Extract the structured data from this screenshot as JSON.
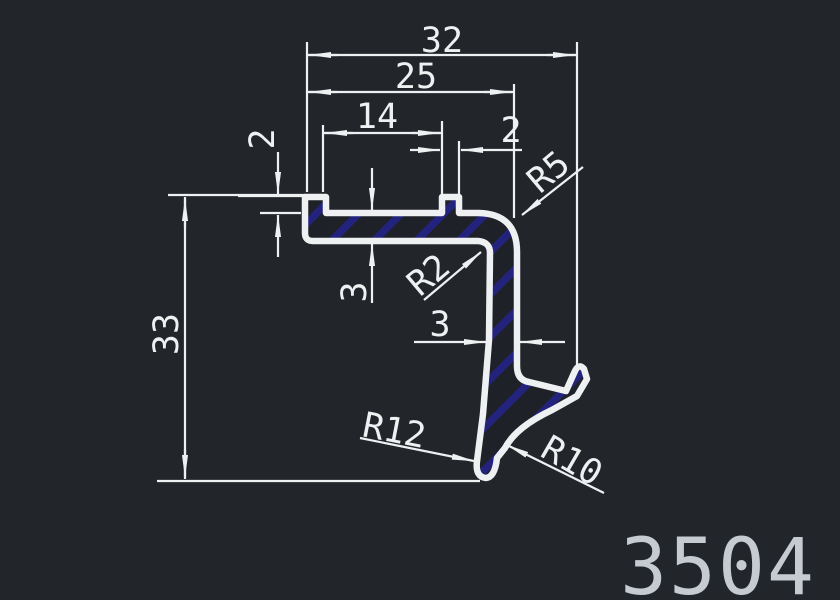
{
  "app": {
    "type_label": "cad-profile-drawing",
    "colors": {
      "background": "#22262b",
      "line": "#eef0f2",
      "hatch_blue": "#23237e",
      "part_number_gray": "#c6cbd1"
    }
  },
  "part": {
    "number": "3504"
  },
  "dimensions": {
    "overall_width": "32",
    "width_to_leg": "25",
    "rib_spacing": "14",
    "rib_width": "2",
    "rib_height": "2",
    "overall_height": "33",
    "flange_thickness": "3",
    "leg_thickness": "3"
  },
  "radii": {
    "outer_corner": "R5",
    "inner_corner": "R2",
    "bottom_outer": "R12",
    "hook_inner": "R10"
  }
}
